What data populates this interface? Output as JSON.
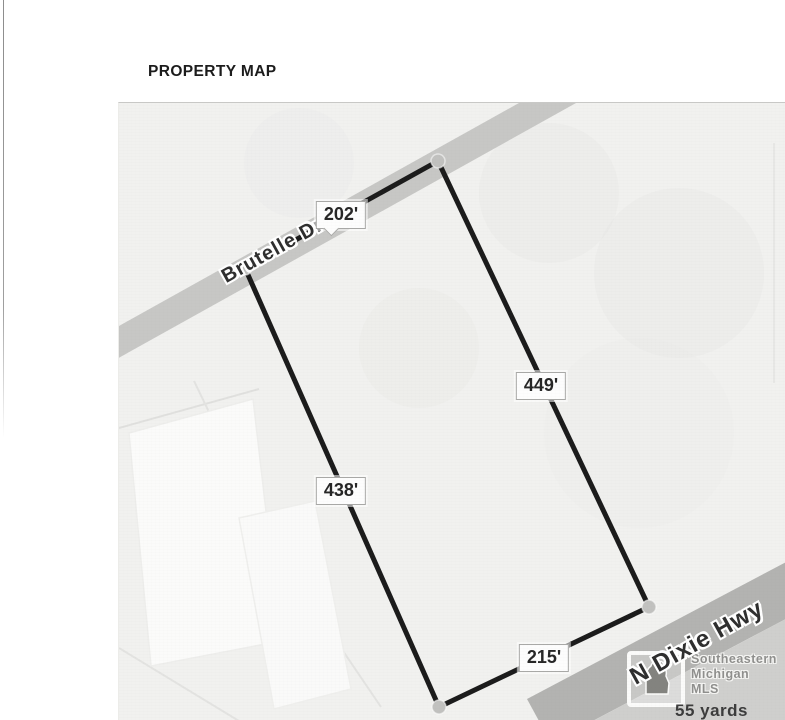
{
  "title": "PROPERTY MAP",
  "map": {
    "streets": {
      "brutelle": "Brutelle Dr",
      "dixie": "N Dixie Hwy"
    },
    "dims": {
      "top": "202'",
      "right": "449'",
      "left": "438'",
      "bottom": "215'"
    },
    "parcel_side_lengths_ft": {
      "top": 202,
      "right": 449,
      "left": 438,
      "bottom": 215
    },
    "logo": {
      "line1": "Southeastern",
      "line2": "Michigan",
      "line3": "MLS"
    },
    "scale_text": "55 yards",
    "colors": {
      "road": "#c7c7c5",
      "highway": "#b3b3b1",
      "corner_lot": "#cfcfcd",
      "parcel_line": "#1b1b1b",
      "vertex_dot": "#c1c1bf",
      "map_bg": "#f1f1ef",
      "label_bg": "#fdfdfd"
    },
    "icons": {
      "michigan": "michigan-state-silhouette"
    }
  }
}
